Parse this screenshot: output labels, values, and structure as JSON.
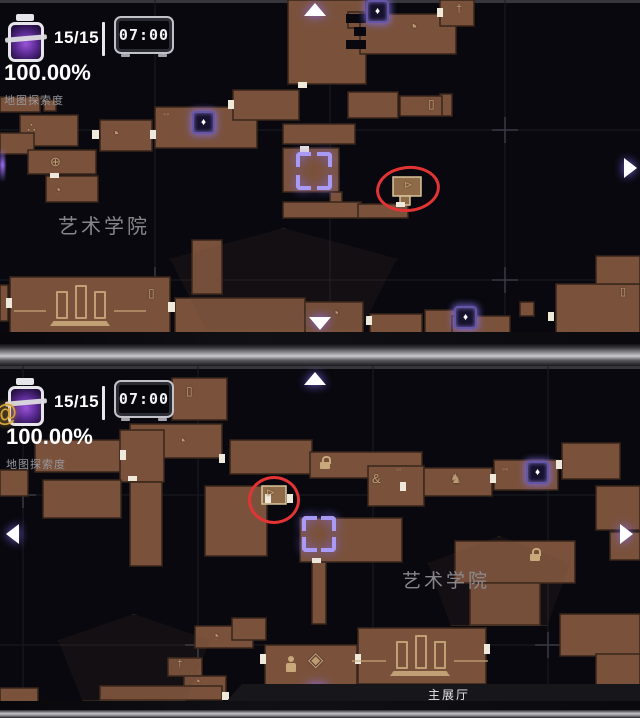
{
  "colors": {
    "background": "#08080e",
    "room_fill": "#7a523c",
    "room_border": "#38261a",
    "room_highlight_fill": "#8f6a48",
    "door_gap": "#efe9dc",
    "annotation_red": "#e23434",
    "marker_purple": "#a99af5",
    "hud_white": "#ffffff",
    "icon_tan": "#c9a87c",
    "gold": "#d4a33c"
  },
  "icons": {
    "anchor": "♦",
    "paw": "∴",
    "swirl": "◔",
    "globe": "⊕",
    "dots": "◦◦",
    "elevator": "▯",
    "flag": "†",
    "dog": "♞",
    "gourd": "&",
    "crest": "◈",
    "statue": "♟",
    "key": "⊳",
    "horn": "@"
  },
  "panels": [
    {
      "name": "top-map-view",
      "hud": {
        "counter": "15/15",
        "clock_time": "07:00",
        "explore_percent": "100.00%",
        "explore_label": "地图探索度"
      },
      "region_label": "艺术学院"
    },
    {
      "name": "bottom-map-view",
      "hud": {
        "counter": "15/15",
        "clock_time": "07:00",
        "explore_percent": "100.00%",
        "explore_label": "地图探索度"
      },
      "region_label": "艺术学院",
      "banner_label": "主展厅"
    }
  ]
}
